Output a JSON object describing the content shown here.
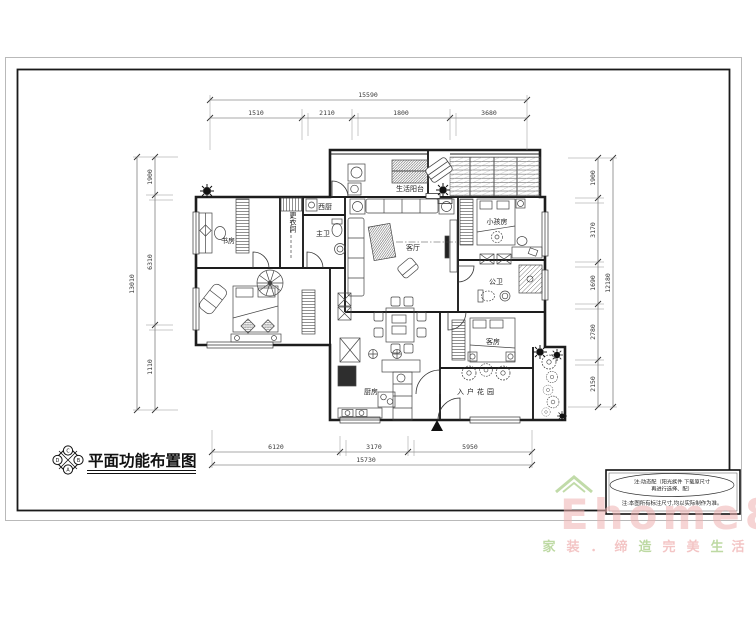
{
  "titleblock": {
    "title": "平面功能布置图"
  },
  "compass": {
    "top": "C",
    "right": "B",
    "bottom": "A",
    "left": "D"
  },
  "rooms": {
    "study": "书房",
    "cloak": "更衣间",
    "west_kitchen": "西厨",
    "master_bath": "主卫",
    "living": "客厅",
    "laundry_balcony": "生活阳台",
    "kids": "小孩房",
    "public_bath": "公卫",
    "guest": "客房",
    "kitchen": "厨房",
    "entry_garden": "入户花园"
  },
  "dims": {
    "top": {
      "total": "15590",
      "segments": [
        "1510",
        "2110",
        "1800",
        "3680"
      ]
    },
    "bottom": {
      "total": "15730",
      "segments": [
        "6120",
        "3170",
        "5950"
      ]
    },
    "left": {
      "total": "13010",
      "segments": [
        "1900",
        "6310",
        "1110"
      ]
    },
    "right": {
      "total": "12180",
      "segments": [
        "1900",
        "3170",
        "1690",
        "2780",
        "2150"
      ]
    }
  },
  "notes": {
    "oval1": "注:动态配（阳光族件 下载原尺寸",
    "oval2": "再进行选择、配）",
    "footer": "注:本图所有标注尺寸,均以实际制作为准。"
  },
  "watermark": {
    "brand": "Ehome8",
    "tagline": [
      "家",
      "装",
      "．",
      "缔",
      "造",
      "完",
      "美",
      "生",
      "活"
    ],
    "pink": "#f0b2b2",
    "green": "#a8cd85"
  },
  "colors": {
    "line": "#1d1d1d",
    "dim": "#3a3a3a"
  }
}
